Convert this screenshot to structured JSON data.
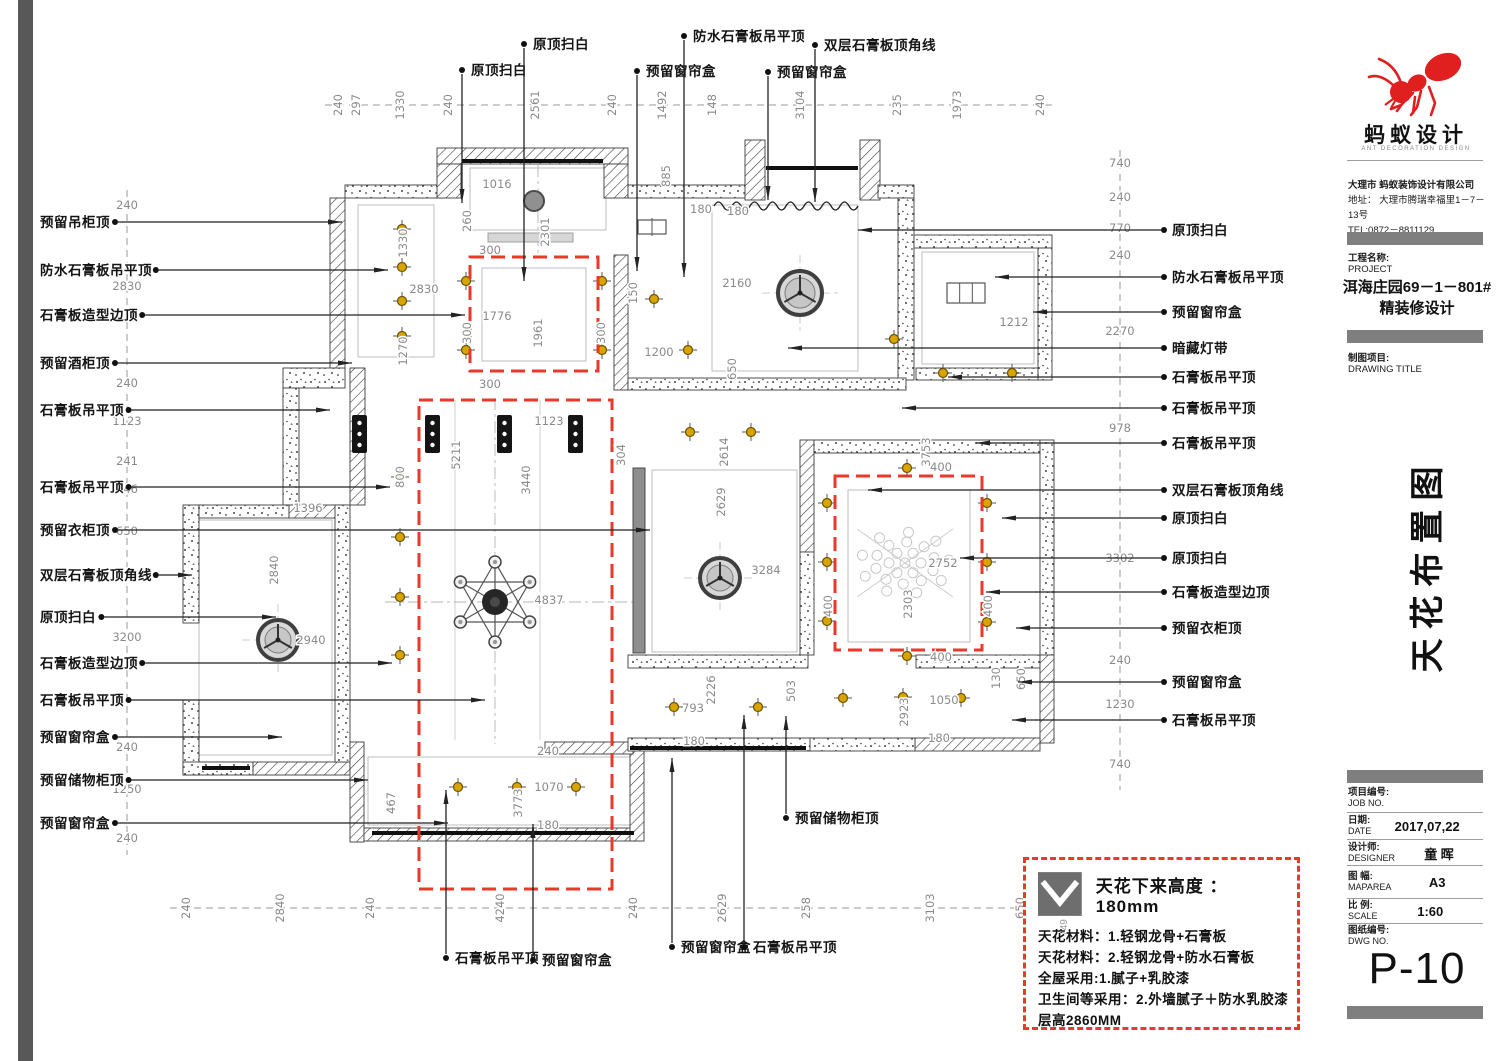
{
  "colors": {
    "red": "#e8392a",
    "gold": "#d9a400",
    "dim": "#8a8a8a",
    "wall_line": "#3c3c3c",
    "bar_gray": "#7f7f7f",
    "logo_red": "#e01f1f"
  },
  "titleblock": {
    "brand": "蚂蚁设计",
    "brand_sub": "ANT DECORATION DESIGN",
    "company_lines": [
      "大理市 蚂蚁装饰设计有限公司",
      "地址： 大理市腾瑞幸福里1－7－13号",
      "TEL:0872－8811129"
    ],
    "project_label": "工程名称:",
    "project_label_en": "PROJECT",
    "project_name": "洱海庄园69－1－801#",
    "project_name2": "精装修设计",
    "drawing_label": "制图项目:",
    "drawing_label_en": "DRAWING TITLE",
    "drawing_title_vertical": "天花布置图",
    "fields": [
      {
        "label": "项目编号:",
        "en": "JOB NO.",
        "value": ""
      },
      {
        "label": "日期:",
        "en": "DATE",
        "value": "2017,07,22"
      },
      {
        "label": "设计师:",
        "en": "DESIGNER",
        "value": "童 晖"
      },
      {
        "label": "图 幅:",
        "en": "MAPAREA",
        "value": "A3"
      },
      {
        "label": "比 例:",
        "en": "SCALE",
        "value": "1:60"
      },
      {
        "label": "图纸编号:",
        "en": "DWG NO.",
        "value": ""
      }
    ],
    "dwg_no": "P-10"
  },
  "legend": {
    "height_note": "天花下来高度 ： 180mm",
    "lines": [
      "天花材料：1.轻钢龙骨+石膏板",
      "天花材料：2.轻钢龙骨+防水石膏板",
      "全屋采用:1.腻子+乳胶漆",
      "卫生间等采用：2.外墙腻子＋防水乳胶漆",
      "层高2860MM"
    ],
    "icon_dim": "749"
  },
  "plan": {
    "labels": {
      "left": [
        [
          "预留吊柜顶",
          222,
          342
        ],
        [
          "防水石膏板吊平顶",
          270,
          388
        ],
        [
          "石膏板造型边顶",
          315,
          465
        ],
        [
          "预留酒柜顶",
          363,
          352
        ],
        [
          "石膏板吊平顶",
          410,
          330
        ],
        [
          "石膏板吊平顶",
          487,
          390
        ],
        [
          "预留衣柜顶",
          530,
          650
        ],
        [
          "双层石膏板顶角线",
          575,
          192
        ],
        [
          "原顶扫白",
          617,
          276
        ],
        [
          "石膏板造型边顶",
          663,
          392
        ],
        [
          "石膏板吊平顶",
          700,
          485
        ],
        [
          "预留窗帘盒",
          737,
          282
        ],
        [
          "预留储物柜顶",
          780,
          368
        ],
        [
          "预留窗帘盒",
          823,
          448
        ]
      ],
      "right": [
        [
          "原顶扫白",
          230,
          858
        ],
        [
          "防水石膏板吊平顶",
          277,
          995
        ],
        [
          "预留窗帘盒",
          312,
          1033
        ],
        [
          "暗藏灯带",
          348,
          788
        ],
        [
          "石膏板吊平顶",
          377,
          948
        ],
        [
          "石膏板吊平顶",
          408,
          902
        ],
        [
          "石膏板吊平顶",
          443,
          976
        ],
        [
          "双层石膏板顶角线",
          490,
          868
        ],
        [
          "原顶扫白",
          518,
          1002
        ],
        [
          "原顶扫白",
          558,
          960
        ],
        [
          "石膏板造型边顶",
          592,
          986
        ],
        [
          "预留衣柜顶",
          628,
          1016
        ],
        [
          "预留窗帘盒",
          682,
          1018
        ],
        [
          "石膏板吊平顶",
          720,
          1012
        ]
      ],
      "top": [
        [
          "原顶扫白",
          462,
          70,
          203
        ],
        [
          "原顶扫白",
          524,
          44,
          281
        ],
        [
          "预留窗帘盒",
          637,
          71,
          271
        ],
        [
          "防水石膏板吊平顶",
          684,
          36,
          277
        ],
        [
          "预留窗帘盒",
          768,
          72,
          200
        ],
        [
          "双层石膏板顶角线",
          815,
          45,
          202
        ]
      ],
      "bottom": [
        [
          "石膏板吊平顶",
          446,
          958,
          790
        ],
        [
          "预留窗帘盒",
          533,
          960,
          824
        ],
        [
          "预留窗帘盒",
          672,
          947,
          758
        ],
        [
          "石膏板吊平顶",
          744,
          947,
          715
        ],
        [
          "预留储物柜顶",
          786,
          818,
          716
        ]
      ]
    },
    "chains": [
      {
        "axis": "x",
        "pos": 105,
        "from": 325,
        "to": 1055,
        "items": [
          [
            240,
            338
          ],
          [
            297,
            356
          ],
          [
            1330,
            400
          ],
          [
            240,
            448
          ],
          [
            2561,
            535
          ],
          [
            240,
            612
          ],
          [
            1492,
            662
          ],
          [
            148,
            712
          ],
          [
            3104,
            800
          ],
          [
            235,
            897
          ],
          [
            1973,
            957
          ],
          [
            240,
            1040
          ]
        ]
      },
      {
        "axis": "x",
        "pos": 908,
        "from": 170,
        "to": 1040,
        "items": [
          [
            240,
            186
          ],
          [
            2840,
            280
          ],
          [
            240,
            370
          ],
          [
            4240,
            500
          ],
          [
            240,
            633
          ],
          [
            2629,
            722
          ],
          [
            258,
            806
          ],
          [
            3103,
            930
          ],
          [
            650,
            1020
          ]
        ]
      },
      {
        "axis": "y",
        "pos": 127,
        "from": 190,
        "to": 855,
        "items": [
          [
            240,
            205
          ],
          [
            2830,
            286
          ],
          [
            240,
            383
          ],
          [
            1123,
            421
          ],
          [
            241,
            461
          ],
          [
            746,
            489
          ],
          [
            650,
            531
          ],
          [
            3200,
            637
          ],
          [
            240,
            747
          ],
          [
            1250,
            789
          ],
          [
            240,
            838
          ]
        ]
      },
      {
        "axis": "y",
        "pos": 1120,
        "from": 150,
        "to": 790,
        "items": [
          [
            740,
            163
          ],
          [
            240,
            197
          ],
          [
            770,
            228
          ],
          [
            240,
            255
          ],
          [
            2270,
            331
          ],
          [
            978,
            428
          ],
          [
            3302,
            558
          ],
          [
            240,
            660
          ],
          [
            1230,
            704
          ],
          [
            740,
            764
          ]
        ]
      }
    ],
    "dims": [
      [
        1016,
        497,
        184,
        0
      ],
      [
        2301,
        545,
        232,
        1
      ],
      [
        260,
        467,
        221,
        1
      ],
      [
        1330,
        403,
        243,
        1
      ],
      [
        2830,
        424,
        289,
        0
      ],
      [
        1270,
        403,
        351,
        1
      ],
      [
        300,
        490,
        250,
        0
      ],
      [
        300,
        467,
        333,
        1
      ],
      [
        300,
        601,
        333,
        1
      ],
      [
        300,
        490,
        384,
        0
      ],
      [
        1776,
        497,
        316,
        0
      ],
      [
        1961,
        538,
        333,
        1
      ],
      [
        150,
        633,
        293,
        1
      ],
      [
        1200,
        659,
        352,
        0
      ],
      [
        2160,
        737,
        283,
        0
      ],
      [
        650,
        732,
        369,
        1
      ],
      [
        885,
        666,
        176,
        1
      ],
      [
        180,
        701,
        209,
        0
      ],
      [
        180,
        738,
        211,
        0
      ],
      [
        1212,
        1014,
        322,
        0
      ],
      [
        1123,
        549,
        421,
        0
      ],
      [
        5211,
        456,
        455,
        1
      ],
      [
        3440,
        526,
        480,
        1
      ],
      [
        800,
        400,
        477,
        1
      ],
      [
        304,
        621,
        455,
        1
      ],
      [
        4837,
        549,
        600,
        0
      ],
      [
        2940,
        311,
        640,
        0
      ],
      [
        2840,
        274,
        570,
        1
      ],
      [
        1396,
        308,
        508,
        0
      ],
      [
        2614,
        724,
        452,
        1
      ],
      [
        2629,
        721,
        502,
        1
      ],
      [
        3284,
        766,
        570,
        0
      ],
      [
        3753,
        926,
        452,
        1
      ],
      [
        400,
        941,
        467,
        0
      ],
      [
        400,
        828,
        606,
        1
      ],
      [
        400,
        988,
        606,
        1
      ],
      [
        400,
        941,
        657,
        0
      ],
      [
        2752,
        943,
        563,
        0
      ],
      [
        2303,
        908,
        604,
        1
      ],
      [
        2923,
        904,
        712,
        1
      ],
      [
        1050,
        944,
        700,
        0
      ],
      [
        130,
        996,
        678,
        1
      ],
      [
        650,
        1021,
        679,
        1
      ],
      [
        793,
        693,
        708,
        0
      ],
      [
        2226,
        711,
        690,
        1
      ],
      [
        503,
        791,
        691,
        1
      ],
      [
        180,
        694,
        741,
        0
      ],
      [
        180,
        939,
        738,
        0
      ],
      [
        467,
        391,
        803,
        1
      ],
      [
        3773,
        518,
        803,
        1
      ],
      [
        1070,
        549,
        787,
        0
      ],
      [
        240,
        548,
        751,
        0
      ],
      [
        180,
        548,
        825,
        0
      ]
    ],
    "walls": [
      [
        345,
        185,
        100,
        13,
        "dot"
      ],
      [
        437,
        148,
        191,
        16,
        "diag"
      ],
      [
        437,
        164,
        24,
        34,
        "diag"
      ],
      [
        604,
        164,
        24,
        34,
        "diag"
      ],
      [
        628,
        185,
        120,
        13,
        "dot"
      ],
      [
        745,
        140,
        20,
        60,
        "diag"
      ],
      [
        860,
        140,
        20,
        60,
        "diag"
      ],
      [
        878,
        185,
        36,
        13,
        "dot"
      ],
      [
        898,
        198,
        16,
        182,
        "dot"
      ],
      [
        914,
        235,
        138,
        13,
        "dot"
      ],
      [
        1038,
        248,
        14,
        132,
        "dot"
      ],
      [
        916,
        368,
        122,
        12,
        "dot"
      ],
      [
        330,
        198,
        15,
        172,
        "diag"
      ],
      [
        283,
        368,
        62,
        20,
        "dot"
      ],
      [
        283,
        388,
        16,
        117,
        "dot"
      ],
      [
        183,
        505,
        16,
        118,
        "dot"
      ],
      [
        183,
        700,
        16,
        75,
        "dot"
      ],
      [
        199,
        505,
        90,
        13,
        "dot"
      ],
      [
        289,
        505,
        58,
        13,
        "diag"
      ],
      [
        183,
        762,
        70,
        13,
        "dot"
      ],
      [
        253,
        762,
        97,
        13,
        "diag"
      ],
      [
        350,
        368,
        15,
        137,
        "diag"
      ],
      [
        335,
        505,
        15,
        257,
        "dot"
      ],
      [
        350,
        742,
        14,
        100,
        "diag"
      ],
      [
        364,
        828,
        276,
        13,
        "diag"
      ],
      [
        630,
        742,
        14,
        99,
        "diag"
      ],
      [
        545,
        742,
        88,
        12,
        "diag"
      ],
      [
        614,
        255,
        14,
        135,
        "diag"
      ],
      [
        628,
        378,
        278,
        12,
        "dot"
      ],
      [
        800,
        440,
        14,
        112,
        "diag"
      ],
      [
        800,
        552,
        14,
        103,
        "dot"
      ],
      [
        628,
        655,
        180,
        13,
        "dot"
      ],
      [
        814,
        440,
        226,
        13,
        "dot"
      ],
      [
        916,
        655,
        124,
        13,
        "dot"
      ],
      [
        1040,
        440,
        14,
        215,
        "dot"
      ],
      [
        1040,
        655,
        14,
        88,
        "diag"
      ],
      [
        915,
        738,
        125,
        13,
        "diag"
      ],
      [
        808,
        738,
        107,
        13,
        "dot"
      ],
      [
        628,
        738,
        182,
        13,
        "dot"
      ],
      [
        633,
        468,
        12,
        185,
        "gray"
      ],
      [
        488,
        233,
        85,
        9,
        "lgray"
      ]
    ],
    "windows": [
      [
        462,
        161,
        603,
        161
      ],
      [
        766,
        168,
        858,
        168
      ],
      [
        372,
        833,
        634,
        833
      ],
      [
        630,
        748,
        806,
        748
      ],
      [
        202,
        768,
        250,
        768
      ]
    ],
    "red_rects": [
      [
        470,
        257,
        128,
        114
      ],
      [
        419,
        400,
        193,
        489
      ],
      [
        835,
        476,
        147,
        174
      ]
    ],
    "inner_rects": [
      [
        358,
        205,
        76,
        152
      ],
      [
        482,
        268,
        104,
        93
      ],
      [
        712,
        205,
        146,
        166
      ],
      [
        652,
        470,
        145,
        182
      ],
      [
        848,
        490,
        122,
        152
      ],
      [
        199,
        520,
        133,
        235
      ],
      [
        368,
        757,
        265,
        68
      ],
      [
        922,
        252,
        112,
        112
      ],
      [
        470,
        168,
        136,
        62
      ]
    ],
    "join_lines": [
      [
        455,
        400,
        455,
        740
      ],
      [
        540,
        400,
        540,
        740
      ]
    ],
    "centerlines": [
      [
        495,
        398,
        495,
        744
      ],
      [
        385,
        602,
        633,
        602
      ],
      [
        538,
        165,
        538,
        255
      ]
    ],
    "lights": [
      [
        402,
        229
      ],
      [
        402,
        267
      ],
      [
        402,
        301
      ],
      [
        402,
        336
      ],
      [
        466,
        281
      ],
      [
        466,
        350
      ],
      [
        602,
        281
      ],
      [
        602,
        350
      ],
      [
        654,
        299
      ],
      [
        688,
        350
      ],
      [
        894,
        339
      ],
      [
        652,
        227
      ],
      [
        966,
        293
      ],
      [
        943,
        373
      ],
      [
        1012,
        373
      ],
      [
        400,
        477
      ],
      [
        400,
        537
      ],
      [
        400,
        597
      ],
      [
        400,
        655
      ],
      [
        690,
        432
      ],
      [
        751,
        432
      ],
      [
        907,
        468
      ],
      [
        827,
        503
      ],
      [
        827,
        562
      ],
      [
        827,
        621
      ],
      [
        987,
        503
      ],
      [
        987,
        562
      ],
      [
        987,
        622
      ],
      [
        907,
        656
      ],
      [
        843,
        698
      ],
      [
        903,
        697
      ],
      [
        961,
        698
      ],
      [
        674,
        707
      ],
      [
        758,
        707
      ],
      [
        458,
        787
      ],
      [
        517,
        787
      ],
      [
        576,
        787
      ]
    ],
    "fans": [
      [
        800,
        293,
        22
      ],
      [
        720,
        578,
        20
      ],
      [
        278,
        640,
        20
      ]
    ],
    "tracks": [
      [
        352,
        415
      ],
      [
        425,
        415
      ],
      [
        497,
        415
      ],
      [
        568,
        415
      ]
    ],
    "chandelier": {
      "x": 495,
      "y": 602,
      "r": 40
    },
    "dome": {
      "x": 534,
      "y": 201,
      "r": 10
    },
    "fixtures": [
      {
        "x": 638,
        "y": 220,
        "w": 28,
        "h": 14,
        "panes": 2
      },
      {
        "x": 947,
        "y": 283,
        "w": 38,
        "h": 20,
        "panes": 3
      }
    ],
    "wavy": {
      "x1": 714,
      "x2": 858,
      "y": 206
    },
    "flower": {
      "x": 905,
      "y": 563
    }
  }
}
